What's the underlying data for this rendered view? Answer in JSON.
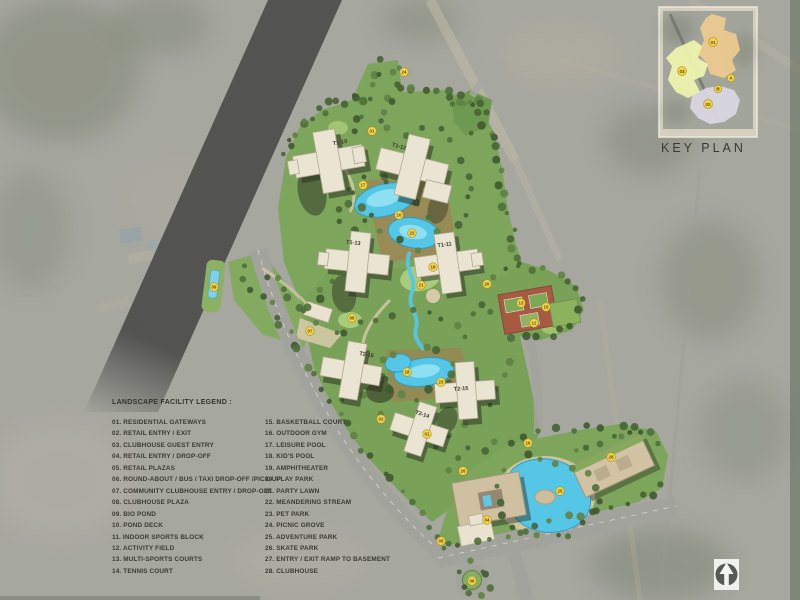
{
  "title": "Landscape Master Plan",
  "legend": {
    "title": "LANDSCAPE FACILITY LEGEND :",
    "columns": [
      {
        "items": [
          "01. RESIDENTIAL GATEWAYS",
          "02. RETAIL ENTRY / EXIT",
          "03. CLUBHOUSE GUEST ENTRY",
          "04. RETAIL ENTRY / DROP-OFF",
          "05. RETAIL PLAZAS",
          "06. ROUND-ABOUT / BUS / TAXI DROP-OFF /PICK-UP",
          "07. COMMUNITY CLUBHOUSE ENTRY / DROP-OFF",
          "08. CLUBHOUSE PLAZA",
          "09. BIO POND",
          "10. POND DECK",
          "11. INDOOR SPORTS BLOCK",
          "12. ACTIVITY FIELD",
          "13. MULTI-SPORTS COURTS",
          "14. TENNIS COURT"
        ]
      },
      {
        "items": [
          "15. BASKETBALL COURT",
          "16. OUTDOOR GYM",
          "17. LEISURE POOL",
          "18. KID'S POOL",
          "19. AMPHITHEATER",
          "20. PLAY PARK",
          "21. PARTY LAWN",
          "22. MEANDERING STREAM",
          "23. PET PARK",
          "24. PICNIC GROVE",
          "25. ADVENTURE PARK",
          "26. SKATE PARK",
          "27. ENTRY / EXIT RAMP TO BASEMENT",
          "28. CLUBHOUSE"
        ]
      }
    ]
  },
  "key_plan": {
    "title": "KEY PLAN",
    "zone_labels": [
      "01",
      "02",
      "03"
    ],
    "point_labels": [
      "A",
      "B"
    ]
  },
  "towers": [
    {
      "label": "T1-10"
    },
    {
      "label": "T1-12"
    },
    {
      "label": "T1-13"
    },
    {
      "label": "T1-11"
    },
    {
      "label": "T2-16"
    },
    {
      "label": "T2-15"
    },
    {
      "label": "T2-14"
    }
  ],
  "site_markers": [
    {
      "label": "24",
      "x": 404,
      "y": 72
    },
    {
      "label": "01",
      "x": 372,
      "y": 131
    },
    {
      "label": "17",
      "x": 363,
      "y": 185
    },
    {
      "label": "10",
      "x": 399,
      "y": 215
    },
    {
      "label": "22",
      "x": 412,
      "y": 233
    },
    {
      "label": "19",
      "x": 433,
      "y": 267
    },
    {
      "label": "21",
      "x": 421,
      "y": 285
    },
    {
      "label": "20",
      "x": 487,
      "y": 284
    },
    {
      "label": "13",
      "x": 521,
      "y": 303
    },
    {
      "label": "15",
      "x": 546,
      "y": 307
    },
    {
      "label": "12",
      "x": 534,
      "y": 323
    },
    {
      "label": "07",
      "x": 310,
      "y": 331
    },
    {
      "label": "08",
      "x": 352,
      "y": 318
    },
    {
      "label": "09",
      "x": 214,
      "y": 287
    },
    {
      "label": "18",
      "x": 407,
      "y": 372
    },
    {
      "label": "23",
      "x": 441,
      "y": 382
    },
    {
      "label": "02",
      "x": 381,
      "y": 419
    },
    {
      "label": "01",
      "x": 427,
      "y": 434
    },
    {
      "label": "16",
      "x": 528,
      "y": 443
    },
    {
      "label": "26",
      "x": 463,
      "y": 471
    },
    {
      "label": "25",
      "x": 560,
      "y": 491
    },
    {
      "label": "28",
      "x": 611,
      "y": 457
    },
    {
      "label": "04",
      "x": 487,
      "y": 520
    },
    {
      "label": "05",
      "x": 441,
      "y": 541
    },
    {
      "label": "06",
      "x": 472,
      "y": 581
    }
  ],
  "colors": {
    "aerial_base": "#a9a8a1",
    "road_dark": "#4f4f4d",
    "green": "#7da55c",
    "pool": "#55c6e6",
    "building": "#eae4d2",
    "marker": "#f3d44a",
    "court_red": "#a75a42"
  }
}
